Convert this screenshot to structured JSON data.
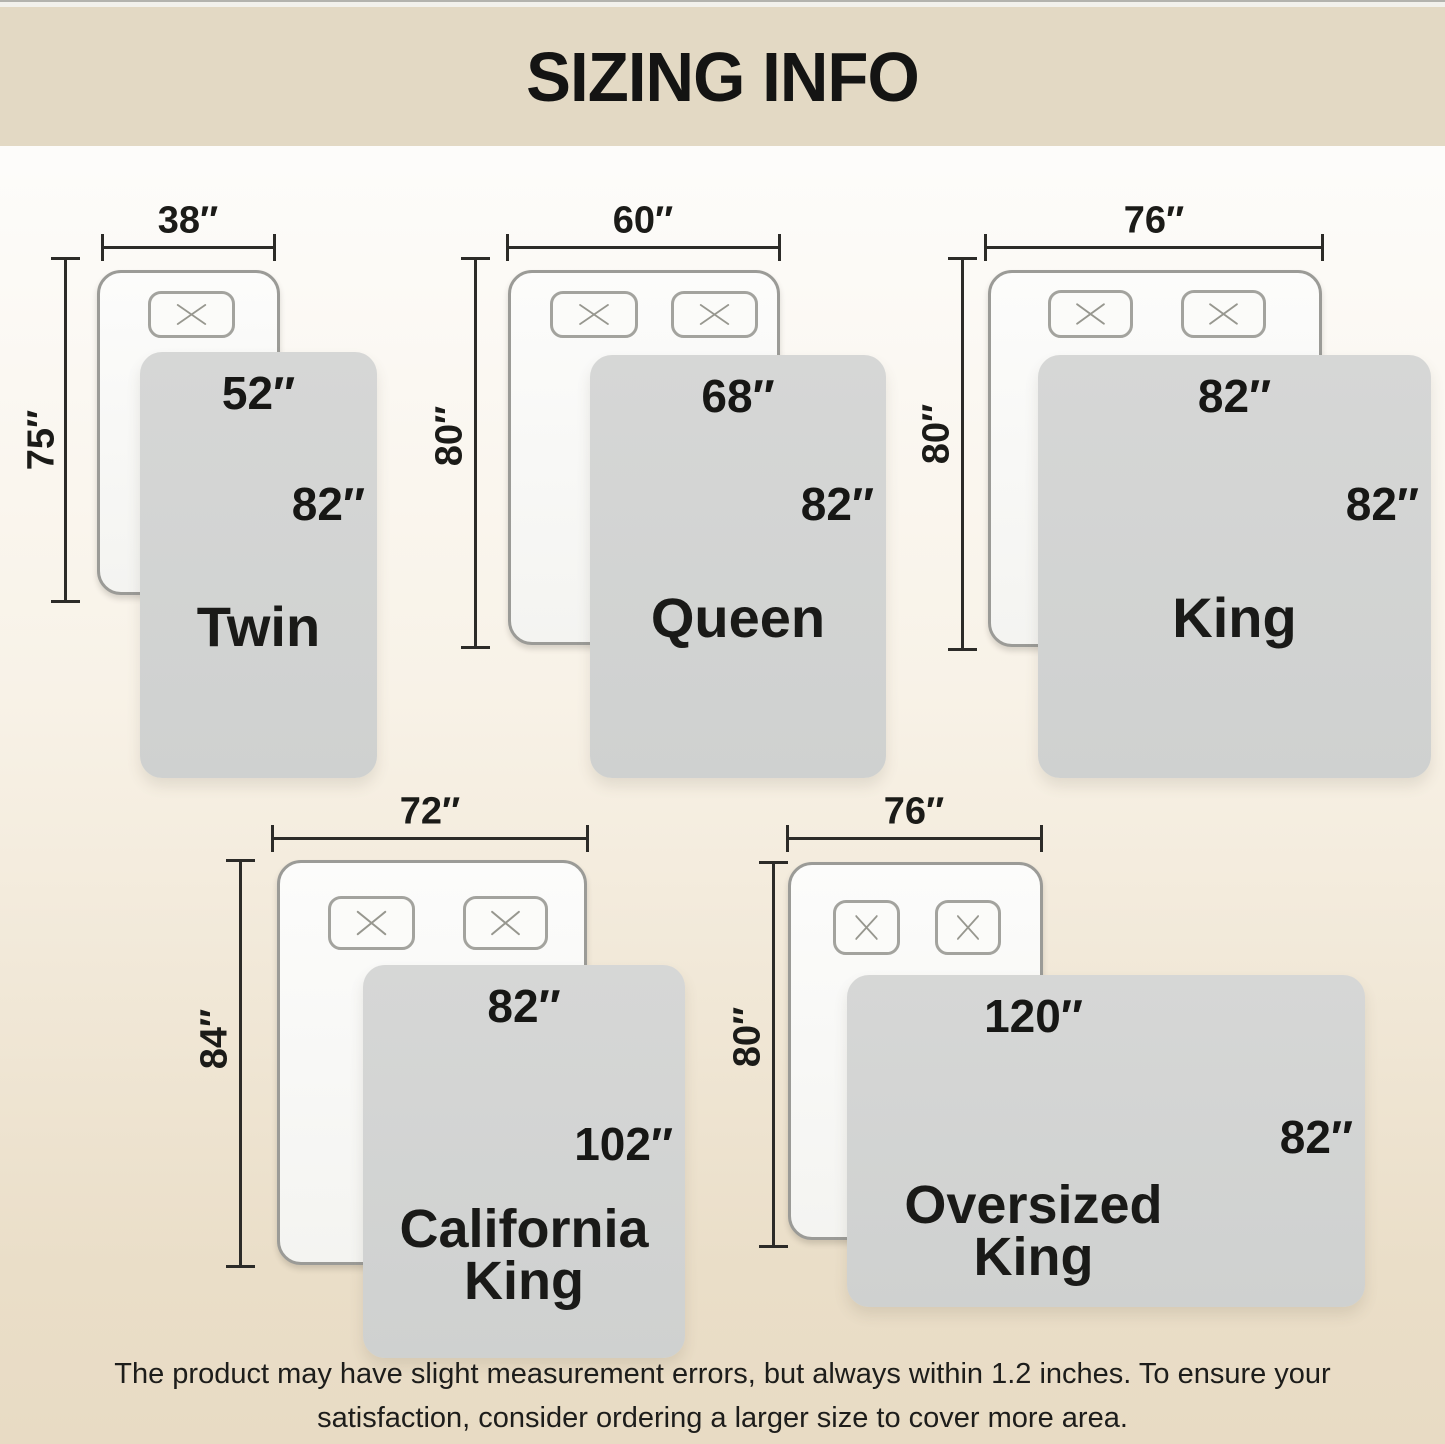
{
  "header": {
    "title": "SIZING INFO"
  },
  "sizes": [
    {
      "name": "Twin",
      "bed_width": "38″",
      "bed_length": "75″",
      "blanket_width": "52″",
      "blanket_length": "82″",
      "pillow_count": 1
    },
    {
      "name": "Queen",
      "bed_width": "60″",
      "bed_length": "80″",
      "blanket_width": "68″",
      "blanket_length": "82″",
      "pillow_count": 2
    },
    {
      "name": "King",
      "bed_width": "76″",
      "bed_length": "80″",
      "blanket_width": "82″",
      "blanket_length": "82″",
      "pillow_count": 2
    },
    {
      "name": "California King",
      "bed_width": "72″",
      "bed_length": "84″",
      "blanket_width": "82″",
      "blanket_length": "102″",
      "pillow_count": 2
    },
    {
      "name": "Oversized King",
      "bed_width": "76″",
      "bed_length": "80″",
      "blanket_width": "120″",
      "blanket_length": "82″",
      "pillow_count": 2
    }
  ],
  "footer": {
    "line1": "The product may have slight measurement errors, but always within 1.2 inches. To ensure your",
    "line2": "satisfaction, consider ordering a larger size to cover more area."
  },
  "colors": {
    "header_bg": "#e3d9c4",
    "page_top": "#fdfcfa",
    "page_bottom": "#e8dbc4",
    "blanket_gray": "#d2d4d3",
    "bed_fill": "#f9f9f7",
    "bed_border": "#9b9b97",
    "dimension_line": "#2c2b28",
    "text": "#161614"
  }
}
